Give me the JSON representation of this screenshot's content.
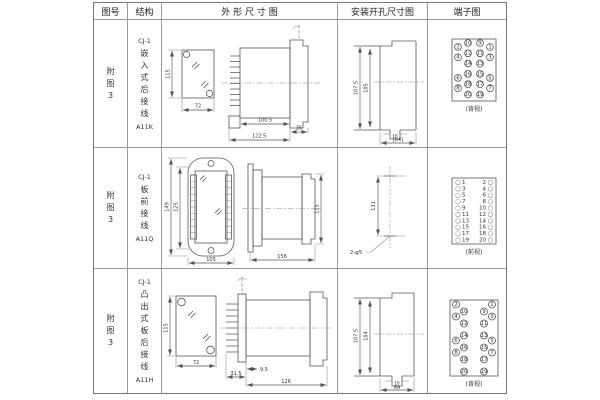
{
  "table": {
    "headers": {
      "figure": "图号",
      "structure": "结构",
      "outline": "外 形 尺 寸 图",
      "mounting": "安装开孔尺寸图",
      "terminal": "端子图"
    }
  },
  "rows": [
    {
      "figure": "附图3",
      "structure": {
        "model": "CJ-1",
        "name": "嵌入式后接线",
        "code": "A11K"
      },
      "outline": {
        "height": "115",
        "width": "72",
        "body_len": "100.5",
        "flange": "35",
        "total_len": "122.5"
      },
      "mounting": {
        "outer_h": "107.5",
        "inner_h": "105",
        "slot_w": "16",
        "bottom_w": "[64]"
      },
      "terminal": {
        "caption": "(背视)"
      }
    },
    {
      "figure": "附图3",
      "structure": {
        "model": "CJ-1",
        "name": "板前接线",
        "code": "A11Q"
      },
      "outline": {
        "outer_h": "149",
        "inner_h": "125",
        "width": "105",
        "length": "156",
        "height": "115"
      },
      "mounting": {
        "distance": "131",
        "holes": "2-φ5"
      },
      "terminal": {
        "caption": "(前视)"
      }
    },
    {
      "figure": "附图3",
      "structure": {
        "model": "CJ-1",
        "name": "凸出式板后接线",
        "code": "A11H"
      },
      "outline": {
        "height": "115",
        "width": "72",
        "fins": "31.5",
        "offset": "9.5",
        "body_len": "126"
      },
      "mounting": {
        "outer_h": "107.5",
        "inner_h": "104",
        "slot_w": "16",
        "bottom_w": "64"
      },
      "terminal": {
        "caption": "(背视)"
      }
    }
  ],
  "terminals": {
    "a11k": {
      "grid": [
        [
          "2",
          "10",
          "9",
          "1"
        ],
        [
          "4",
          "12",
          "11",
          "3"
        ],
        [
          "14",
          "13"
        ],
        [
          "6",
          "16",
          "15",
          "5"
        ],
        [
          "8",
          "18",
          "17",
          "7"
        ],
        [
          "20",
          "19"
        ]
      ]
    },
    "a11q": {
      "left": [
        "1",
        "3",
        "5",
        "7",
        "9",
        "11",
        "13",
        "15",
        "17",
        "19"
      ],
      "right": [
        "2",
        "4",
        "6",
        "8",
        "10",
        "12",
        "14",
        "16",
        "18",
        "20"
      ]
    },
    "a11h": {
      "grid": [
        [
          "2",
          "10",
          "9",
          "1"
        ],
        [
          "4",
          "12",
          "11",
          "3"
        ],
        [
          "14",
          "13"
        ],
        [
          "6",
          "16",
          "15",
          "5"
        ],
        [
          "8",
          "18",
          "17",
          "7"
        ],
        [
          "20",
          "19"
        ]
      ]
    }
  }
}
